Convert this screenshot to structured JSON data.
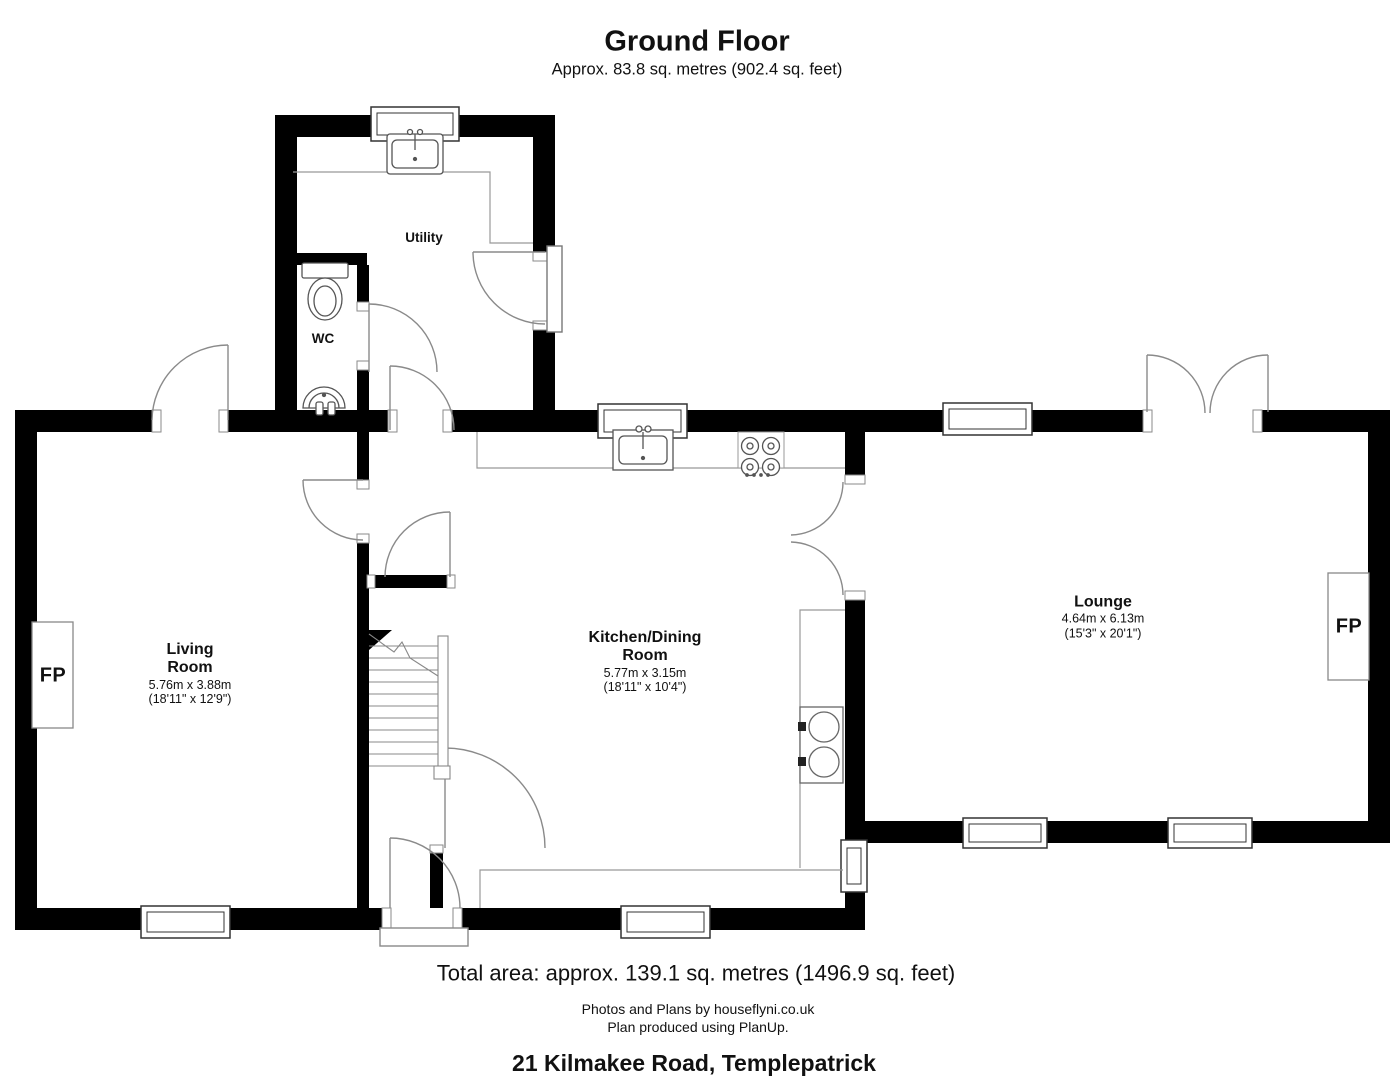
{
  "title": "Ground Floor",
  "subtitle": "Approx. 83.8 sq. metres (902.4 sq. feet)",
  "rooms": {
    "utility": {
      "name": "Utility"
    },
    "wc": {
      "name": "WC"
    },
    "living": {
      "name_line1": "Living",
      "name_line2": "Room",
      "dims_metric": "5.76m x 3.88m",
      "dims_imperial": "(18'11\" x 12'9\")"
    },
    "kitchen": {
      "name_line1": "Kitchen/Dining",
      "name_line2": "Room",
      "dims_metric": "5.77m x 3.15m",
      "dims_imperial": "(18'11\" x 10'4\")"
    },
    "lounge": {
      "name": "Lounge",
      "dims_metric": "4.64m x 6.13m",
      "dims_imperial": "(15'3\" x 20'1\")"
    }
  },
  "fireplace_label": "FP",
  "footer": {
    "total_area": "Total area: approx. 139.1 sq. metres (1496.9 sq. feet)",
    "credit_line1": "Photos and Plans by houseflyni.co.uk",
    "credit_line2": "Plan produced using PlanUp.",
    "address": "21 Kilmakee Road, Templepatrick"
  },
  "colors": {
    "wall": "#000000",
    "background": "#ffffff",
    "door_arc": "#8a8a8a",
    "fixture": "#555555"
  }
}
